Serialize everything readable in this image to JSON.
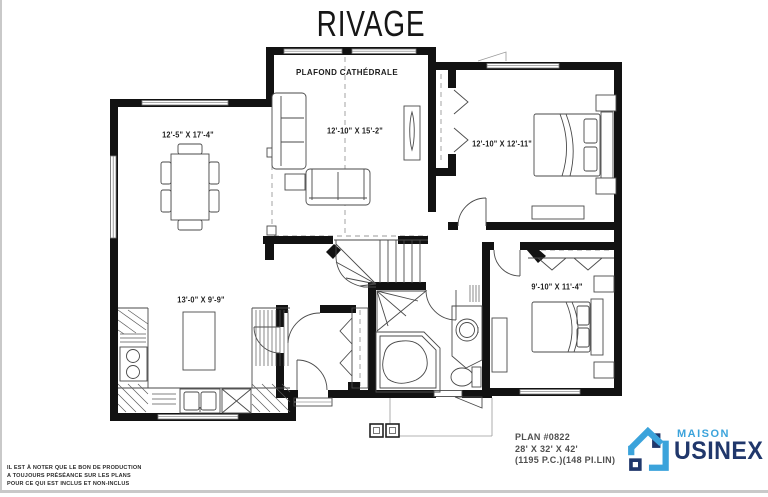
{
  "title": "RIVAGE",
  "plan": {
    "ceiling_note": "PLAFOND CATHÉDRALE",
    "rooms": [
      {
        "id": "dining",
        "dims": "12'-5\" X 17'-4\""
      },
      {
        "id": "living",
        "dims": "12'-10\" X 15'-2\""
      },
      {
        "id": "bedroom-1",
        "dims": "12'-10\" X 12'-11\""
      },
      {
        "id": "kitchen",
        "dims": "13'-0\" X 9'-9\""
      },
      {
        "id": "bedroom-2",
        "dims": "9'-10\" X 11'-4\""
      }
    ]
  },
  "info": {
    "plan_number": "PLAN #0822",
    "exterior_dimensions": "28' X 32' X 42'",
    "area": "(1195 P.C.)(148 PI.LIN)"
  },
  "logo": {
    "word_top": "MAISON",
    "word_bottom": "USINEX",
    "color_light": "#3BA3DB",
    "color_dark": "#20376B"
  },
  "disclaimer": {
    "line1": "IL EST À NOTER QUE LE BON DE PRODUCTION",
    "line2": "A TOUJOURS PRÉSÉANCE SUR LES PLANS",
    "line3": "POUR CE QUI EST INCLUS ET NON-INCLUS"
  }
}
